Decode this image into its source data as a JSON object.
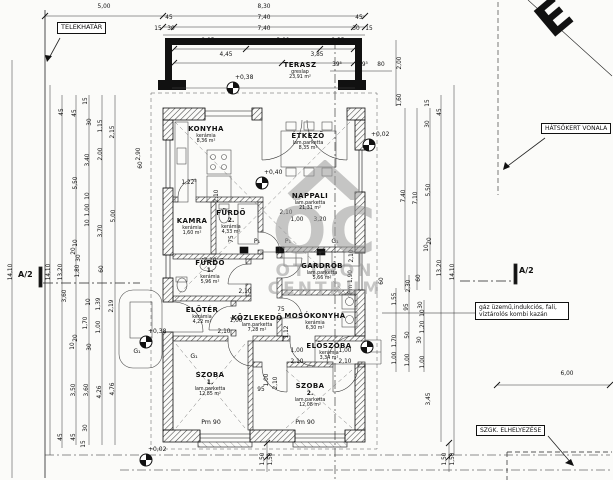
{
  "labels": {
    "telekhatar": "TELEKHATÁR",
    "hatsokert": "HÁTSÓKERT VONALA",
    "szgk": "SZGK. ELHELYEZÉSE",
    "gaz1": "gáz üzemű,indukciós, fali,",
    "gaz2": "víztárolós kombi kazán",
    "a2": "A/2",
    "north": "E"
  },
  "watermark": {
    "monogram": "OC",
    "line1": "OTTHON",
    "line2": "CENTRUM"
  },
  "rooms": [
    {
      "name": "TERASZ",
      "sub": "",
      "mat": "greslap",
      "area": "23,91 m²",
      "x": 300,
      "y": 62
    },
    {
      "name": "KONYHA",
      "sub": "",
      "mat": "kerámia",
      "area": "8,36 m²",
      "x": 206,
      "y": 126
    },
    {
      "name": "ÉTKEZŐ",
      "sub": "",
      "mat": "lam.parketta",
      "area": "8,35 m²",
      "x": 308,
      "y": 133
    },
    {
      "name": "KAMRA",
      "sub": "",
      "mat": "kerámia",
      "area": "1,60 m²",
      "x": 192,
      "y": 218
    },
    {
      "name": "FÜRDŐ",
      "sub": "2.",
      "mat": "kerámia",
      "area": "4,33 m²",
      "x": 231,
      "y": 210
    },
    {
      "name": "NAPPALI",
      "sub": "",
      "mat": "lam.parketta",
      "area": "21,31 m²",
      "x": 310,
      "y": 193
    },
    {
      "name": "FÜRDŐ",
      "sub": "1.",
      "mat": "kerámia",
      "area": "5,96 m²",
      "x": 210,
      "y": 260
    },
    {
      "name": "ELŐTÉR",
      "sub": "",
      "mat": "kerámia",
      "area": "4,22 m²",
      "x": 202,
      "y": 307
    },
    {
      "name": "KÖZLEKEDŐ",
      "sub": "",
      "mat": "lam.parketta",
      "area": "7,28 m²",
      "x": 257,
      "y": 315
    },
    {
      "name": "GARDRÓB",
      "sub": "",
      "mat": "lam.parketta",
      "area": "5,66 m²",
      "x": 322,
      "y": 263
    },
    {
      "name": "MOSÓKONYHA",
      "sub": "",
      "mat": "kerámia",
      "area": "6,30 m²",
      "x": 315,
      "y": 313
    },
    {
      "name": "ELŐSZOBA",
      "sub": "",
      "mat": "kerámia",
      "area": "3,34 m²",
      "x": 329,
      "y": 343
    },
    {
      "name": "SZOBA",
      "sub": "1.",
      "mat": "lam.parketta",
      "area": "12,85 m²",
      "x": 210,
      "y": 372
    },
    {
      "name": "SZOBA",
      "sub": "2.",
      "mat": "lam.parketta",
      "area": "12,08 m²",
      "x": 310,
      "y": 383
    }
  ],
  "dims": [
    [
      "5,00",
      104,
      8,
      0
    ],
    [
      "8,30",
      264,
      8,
      0
    ],
    [
      "45",
      169,
      19,
      0
    ],
    [
      "7,40",
      264,
      19,
      0
    ],
    [
      "45",
      359,
      19,
      0
    ],
    [
      "15",
      158,
      30,
      0
    ],
    [
      "30",
      171,
      30,
      0
    ],
    [
      "7,40",
      264,
      30,
      0
    ],
    [
      "30",
      356,
      30,
      0
    ],
    [
      "15",
      369,
      30,
      0
    ],
    [
      "2,95",
      208,
      42,
      0
    ],
    [
      "3,00",
      283,
      42,
      0
    ],
    [
      "2,35",
      338,
      42,
      0
    ],
    [
      "4,45",
      226,
      56,
      0
    ],
    [
      "3,85",
      317,
      56,
      0
    ],
    [
      "39⁵",
      337,
      66,
      0
    ],
    [
      "39⁵",
      363,
      66,
      0
    ],
    [
      "80",
      381,
      66,
      0
    ],
    [
      "2,00",
      401,
      63,
      1
    ],
    [
      "1,60",
      401,
      100,
      1
    ],
    [
      "15",
      429,
      103,
      1
    ],
    [
      "45",
      441,
      112,
      1
    ],
    [
      "14,10",
      12,
      272,
      1
    ],
    [
      "14,10",
      50,
      272,
      1
    ],
    [
      "13,20",
      62,
      272,
      1
    ],
    [
      "45",
      63,
      112,
      1
    ],
    [
      "45",
      76,
      113,
      1
    ],
    [
      "15",
      87,
      101,
      1
    ],
    [
      "30",
      91,
      122,
      1
    ],
    [
      "1,15",
      102,
      126,
      1
    ],
    [
      "2,15",
      114,
      132,
      1
    ],
    [
      "2,00",
      102,
      154,
      1
    ],
    [
      "3,40",
      89,
      160,
      1
    ],
    [
      "5,50",
      77,
      183,
      1
    ],
    [
      "2,90",
      140,
      154,
      1
    ],
    [
      "60",
      142,
      165,
      1
    ],
    [
      "10",
      89,
      196,
      1
    ],
    [
      "1,00",
      89,
      210,
      1
    ],
    [
      "10",
      89,
      223,
      1
    ],
    [
      "5,00",
      115,
      216,
      1
    ],
    [
      "3,70",
      102,
      231,
      1
    ],
    [
      "10",
      77,
      243,
      1
    ],
    [
      "20",
      75,
      251,
      1
    ],
    [
      "30",
      80,
      258,
      1
    ],
    [
      "1,80",
      79,
      271,
      1
    ],
    [
      "60",
      103,
      269,
      1
    ],
    [
      "3,60",
      66,
      296,
      1
    ],
    [
      "10",
      90,
      302,
      1
    ],
    [
      "1,39",
      100,
      304,
      1
    ],
    [
      "2,19",
      113,
      306,
      1
    ],
    [
      "1,70",
      87,
      323,
      1
    ],
    [
      "1,00",
      100,
      327,
      1
    ],
    [
      "20",
      77,
      338,
      1
    ],
    [
      "10",
      74,
      346,
      1
    ],
    [
      "30",
      91,
      347,
      1
    ],
    [
      "3,50",
      75,
      390,
      1
    ],
    [
      "3,60",
      88,
      390,
      1
    ],
    [
      "4,26",
      101,
      392,
      1
    ],
    [
      "4,76",
      114,
      389,
      1
    ],
    [
      "45",
      62,
      437,
      1
    ],
    [
      "45",
      75,
      437,
      1
    ],
    [
      "30",
      87,
      428,
      1
    ],
    [
      "15",
      85,
      444,
      1
    ],
    [
      "7,40",
      405,
      196,
      1
    ],
    [
      "7,10",
      417,
      198,
      1
    ],
    [
      "5,50",
      430,
      190,
      1
    ],
    [
      "30",
      429,
      124,
      1
    ],
    [
      "20",
      431,
      241,
      1
    ],
    [
      "10",
      428,
      248,
      1
    ],
    [
      "60",
      383,
      281,
      1
    ],
    [
      "2,30",
      410,
      286,
      1
    ],
    [
      "60",
      420,
      278,
      1
    ],
    [
      "13,20",
      441,
      268,
      1
    ],
    [
      "14,10",
      454,
      272,
      1
    ],
    [
      "1,55",
      396,
      299,
      1
    ],
    [
      "95",
      408,
      307,
      1
    ],
    [
      "30",
      422,
      305,
      1
    ],
    [
      "10",
      424,
      313,
      1
    ],
    [
      "1,20",
      424,
      327,
      1
    ],
    [
      "50",
      409,
      335,
      1
    ],
    [
      "30",
      421,
      340,
      1
    ],
    [
      "1,70",
      396,
      341,
      1
    ],
    [
      "1,00",
      396,
      358,
      1
    ],
    [
      "1,00",
      409,
      360,
      1
    ],
    [
      "1,00",
      424,
      362,
      1
    ],
    [
      "3,45",
      430,
      399,
      1
    ],
    [
      "6,00",
      567,
      375,
      0
    ],
    [
      "1,50",
      264,
      459,
      1
    ],
    [
      "1,50",
      272,
      459,
      1
    ],
    [
      "1,50",
      446,
      459,
      1
    ],
    [
      "1,50",
      454,
      459,
      1
    ],
    [
      "1,22⁵",
      189,
      184,
      0
    ],
    [
      "2,10",
      218,
      196,
      1
    ],
    [
      "2,10",
      245,
      293,
      0
    ],
    [
      "3,10",
      210,
      262,
      0
    ],
    [
      "2,10",
      286,
      214,
      0
    ],
    [
      "1,00",
      297,
      221,
      0
    ],
    [
      "3,20",
      320,
      221,
      0
    ],
    [
      "1,00",
      236,
      322,
      0
    ],
    [
      "2,10",
      224,
      333,
      0
    ],
    [
      "75",
      281,
      311,
      0
    ],
    [
      "1,12",
      288,
      332,
      1
    ],
    [
      "1,00",
      297,
      352,
      0
    ],
    [
      "2,10",
      297,
      363,
      0
    ],
    [
      "1,00",
      345,
      352,
      0
    ],
    [
      "2,10",
      345,
      363,
      0
    ],
    [
      "95",
      261,
      391,
      0
    ],
    [
      "1,00",
      268,
      380,
      1
    ],
    [
      "2,10",
      277,
      383,
      1
    ],
    [
      "2,10",
      353,
      256,
      1
    ],
    [
      "Pm 1,90",
      352,
      282,
      1
    ],
    [
      "75",
      233,
      239,
      1
    ]
  ],
  "texts": [
    [
      "Pm 90",
      211,
      423
    ],
    [
      "Pm 90",
      305,
      423
    ],
    [
      "G₁",
      137,
      352
    ],
    [
      "G₁",
      194,
      357
    ],
    [
      "P₁",
      257,
      242
    ],
    [
      "P₁",
      288,
      242
    ],
    [
      "G₁",
      335,
      242
    ]
  ],
  "markers": [
    {
      "t": "+0,38",
      "x": 233,
      "y": 88
    },
    {
      "t": "+0,40",
      "x": 262,
      "y": 183
    },
    {
      "t": "+0,02",
      "x": 369,
      "y": 145
    },
    {
      "t": "",
      "x": 367,
      "y": 347
    },
    {
      "t": "+0,38",
      "x": 146,
      "y": 342
    },
    {
      "t": "+0,02",
      "x": 146,
      "y": 460
    }
  ]
}
